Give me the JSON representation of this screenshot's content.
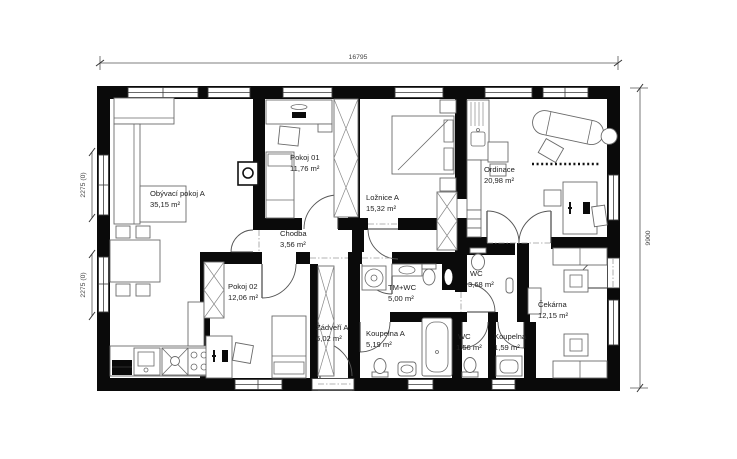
{
  "plan": {
    "type": "floor-plan",
    "dimensions": {
      "width_top": "16795",
      "height_right": "9900",
      "left_window_upper": "2275 (0)",
      "left_window_lower": "2275 (0)"
    },
    "rooms": [
      {
        "name": "Obývací pokoj A",
        "area": "35,15 m²"
      },
      {
        "name": "Pokoj 01",
        "area": "11,76 m²"
      },
      {
        "name": "Ložnice A",
        "area": "15,32 m²"
      },
      {
        "name": "Ordinace",
        "area": "20,98 m²"
      },
      {
        "name": "Chodba",
        "area": "3,56 m²"
      },
      {
        "name": "Pokoj 02",
        "area": "12,06 m²"
      },
      {
        "name": "Zádveří A",
        "area": "6,02 m²"
      },
      {
        "name": "TM+WC",
        "area": "5,00 m²"
      },
      {
        "name": "Koupelna A",
        "area": "5,19 m²"
      },
      {
        "name": "WC",
        "area": "3,68 m²"
      },
      {
        "name": "WC",
        "area": "1,56 m²"
      },
      {
        "name": "Koupelna",
        "area": "1,59 m²"
      },
      {
        "name": "Čekárna",
        "area": "12,15 m²"
      }
    ]
  }
}
